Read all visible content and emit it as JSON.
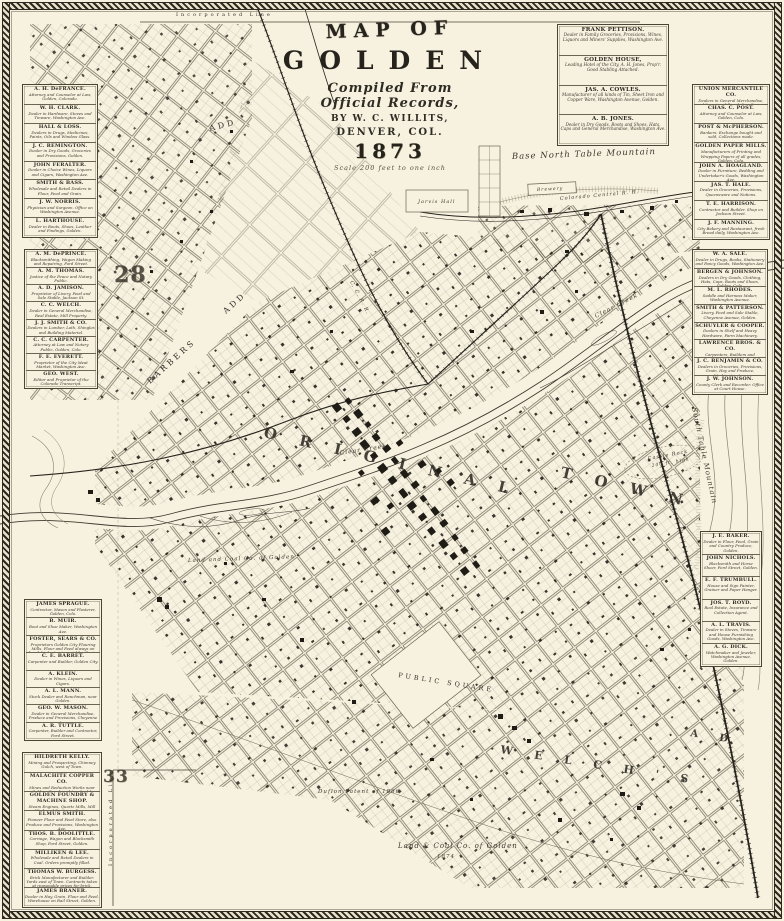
{
  "title": {
    "map_of": "MAP OF",
    "city": "GOLDEN",
    "compiled": "Compiled From",
    "records": "Official Records,",
    "by": "BY W. C. WILLITS,",
    "place": "DENVER, COL.",
    "year": "1873",
    "scale": "Scale 200 feet to one inch"
  },
  "colors": {
    "paper": "#f7f2e0",
    "ink": "#2e2b23",
    "faded_ink": "#6d6553"
  },
  "directories": {
    "top_right": {
      "entries": [
        {
          "name": "FRANK PETTISON.",
          "desc": "Dealer in Family Groceries, Provisions, Wines, Liquors and Miners' Supplies, Washington Ave."
        },
        {
          "name": "GOLDEN HOUSE,",
          "desc": "Leading Hotel of the City, A. H. Jones, Prop'r. Good Stabling Attached."
        },
        {
          "name": "JAS. A. COWLES.",
          "desc": "Manufacturer of all kinds of Tin, Sheet Iron and Copper Ware, Washington Avenue, Golden."
        },
        {
          "name": "A. B. JONES.",
          "desc": "Dealer in Dry Goods, Boots and Shoes, Hats, Caps and General Merchandise, Washington Ave."
        }
      ]
    },
    "left_groups": [
      {
        "entries": [
          {
            "name": "A. H. DeFRANCE.",
            "desc": "Attorney and Counselor at Law, Golden, Colorado."
          },
          {
            "name": "W. H. CLARK.",
            "desc": "Dealer in Hardware, Stoves and Tinware, Washington Ave."
          },
          {
            "name": "HALL & LOSS.",
            "desc": "Dealers in Drugs, Medicines, Paints, Oils and Window Glass."
          },
          {
            "name": "J. C. REMINGTON.",
            "desc": "Dealer in Dry Goods, Groceries and Provisions, Golden."
          },
          {
            "name": "JOHN FERALTER.",
            "desc": "Dealer in Choice Wines, Liquors and Cigars, Washington Ave."
          },
          {
            "name": "SMITH & BASS.",
            "desc": "Wholesale and Retail Dealers in Flour, Feed and Grain."
          },
          {
            "name": "J. W. NORRIS.",
            "desc": "Physician and Surgeon. Office on Washington Avenue."
          },
          {
            "name": "L. HARTHOUSE.",
            "desc": "Dealer in Boots, Shoes, Leather and Findings, Golden."
          }
        ]
      },
      {
        "entries": [
          {
            "name": "A. M. DePRINCE.",
            "desc": "Blacksmithing, Wagon Making and Repairing, Ford Street."
          },
          {
            "name": "A. M. THOMAS.",
            "desc": "Justice of the Peace and Notary Public."
          },
          {
            "name": "A. D. JAMISON.",
            "desc": "Proprietor of Livery, Feed and Sale Stable, Jackson St."
          },
          {
            "name": "C. C. WELCH.",
            "desc": "Dealer in General Merchandise, Real Estate, Mill Property."
          },
          {
            "name": "J. J. SMITH & CO.",
            "desc": "Dealers in Lumber, Lath, Shingles and Building Material."
          },
          {
            "name": "C. C. CARPENTER.",
            "desc": "Attorney at Law and Notary Public, Golden, Colo."
          },
          {
            "name": "F. E. EVERETT.",
            "desc": "Proprietor of the City Meat Market, Washington Ave."
          },
          {
            "name": "GEO. WEST.",
            "desc": "Editor and Proprietor of the Colorado Transcript."
          }
        ]
      },
      {
        "entries": [
          {
            "name": "JAMES SPRAGUE.",
            "desc": "Contractor, Mason and Plasterer, Golden, Colo."
          },
          {
            "name": "B. MUIR.",
            "desc": "Boot and Shoe Maker, Washington Ave."
          },
          {
            "name": "FOSTER, SEARS & CO.",
            "desc": "Proprietors Golden City Flouring Mills. Flour and Feed always on hand, highest price paid for Grain."
          },
          {
            "name": "C. E. BARRET.",
            "desc": "Carpenter and Builder, Golden City."
          },
          {
            "name": "A. KLEIN.",
            "desc": "Dealer in Wines, Liquors and Cigars."
          },
          {
            "name": "A. L. MANN.",
            "desc": "Stock Dealer and Ranchman, near Golden."
          },
          {
            "name": "GEO. W. MASON.",
            "desc": "Dealer in General Merchandise, Produce and Provisions, Cheyenne Ave."
          },
          {
            "name": "A. R. TUTTLE.",
            "desc": "Carpenter, Builder and Contractor, Ford Street."
          }
        ]
      },
      {
        "entries": [
          {
            "name": "HILDRETH KELLY.",
            "desc": "Mining and Prospecting, Chimney Gulch, west of Town."
          },
          {
            "name": "MALACHITE COPPER CO.",
            "desc": "Mines and Reduction Works near Golden. Ores bought and sold."
          },
          {
            "name": "GOLDEN FOUNDRY & MACHINE SHOP.",
            "desc": "Steam Engines, Quartz Mills, Mill Work and Castings of every description. Repairing promptly done."
          },
          {
            "name": "ELMUS SMITH.",
            "desc": "Pioneer Flour and Feed Store, also Produce and Provisions, Washington Ave."
          },
          {
            "name": "THOS. B. DOOLITTLE.",
            "desc": "Carriage, Wagon and Blacksmith Shop, Ford Street, Golden."
          },
          {
            "name": "MILLIKEN & LEE.",
            "desc": "Wholesale and Retail Dealers in Coal. Orders promptly filled."
          },
          {
            "name": "THOMAS W. BURGESS.",
            "desc": "Brick Manufacturer and Builder. Yards east of Town. Contracts taken at reasonable prices for brick."
          },
          {
            "name": "JAMES BRANER.",
            "desc": "Dealer in Hay, Grain, Flour and Feed. Warehouse on Rail Street, Golden."
          }
        ]
      }
    ],
    "right_groups": [
      {
        "entries": [
          {
            "name": "UNION MERCANTILE CO.",
            "desc": "Dealers in General Merchandise, Miners' and Ranch Supplies, Washington Ave."
          },
          {
            "name": "CHAS. C. POST.",
            "desc": "Attorney and Counselor at Law, Golden, Colo."
          },
          {
            "name": "POST & McPHERSON.",
            "desc": "Bankers. Exchange bought and sold, Collections made."
          },
          {
            "name": "GOLDEN PAPER MILLS.",
            "desc": "Manufacturers of Printing and Wrapping Papers of all grades, Golden, Colo."
          },
          {
            "name": "JOHN A. HOAGLAND.",
            "desc": "Dealer in Furniture, Bedding and Undertaker's Goods, Washington Ave."
          },
          {
            "name": "JAS. T. HALE.",
            "desc": "Dealer in Groceries, Provisions, Queensware and Notions."
          },
          {
            "name": "T. E. HARRISON.",
            "desc": "Contractor and Builder. Shop on Jackson Street."
          },
          {
            "name": "J. F. MANNING.",
            "desc": "City Bakery and Restaurant, fresh Bread daily, Washington Ave."
          }
        ]
      },
      {
        "entries": [
          {
            "name": "W. A. SALE.",
            "desc": "Dealer in Drugs, Books, Stationery and Fancy Goods, Washington Ave."
          },
          {
            "name": "BERGEN & JOHNSON.",
            "desc": "Dealers in Dry Goods, Clothing, Hats, Caps, Boots and Shoes, Golden, Colo."
          },
          {
            "name": "M. L. RHODES.",
            "desc": "Saddle and Harness Maker, Washington Avenue."
          },
          {
            "name": "SMITH & PATTERSON.",
            "desc": "Livery, Feed and Sale Stable, Cheyenne Avenue, Golden."
          },
          {
            "name": "SCHUYLER & COOPER.",
            "desc": "Dealers in Shelf and Heavy Hardware, Farm Machinery."
          },
          {
            "name": "LAWRENCE BROS. & CO.",
            "desc": "Carpenters, Builders and Contractors, Golden, Colo."
          },
          {
            "name": "J. C. BENJAMIN & CO.",
            "desc": "Dealers in Groceries, Provisions, Grain, Hay and Produce, Washington Ave."
          },
          {
            "name": "J. W. JOHNSON.",
            "desc": "County Clerk and Recorder. Office at Court House."
          }
        ]
      },
      {
        "entries": [
          {
            "name": "J. E. BAKER.",
            "desc": "Dealer in Flour, Feed, Grain and Country Produce, Golden."
          },
          {
            "name": "JOHN NICHOLS.",
            "desc": "Blacksmith and Horse Shoer, Ford Street, Golden."
          },
          {
            "name": "E. F. TRUMBULL.",
            "desc": "House and Sign Painter, Grainer and Paper Hanger."
          },
          {
            "name": "JOS. T. BOYD.",
            "desc": "Real Estate, Insurance and Collection Agent."
          },
          {
            "name": "A. L. TRAVIS.",
            "desc": "Dealer in Stoves, Tinware and House Furnishing Goods, Washington Ave."
          },
          {
            "name": "A. G. DICK.",
            "desc": "Watchmaker and Jeweler, Washington Avenue, Golden."
          }
        ]
      }
    ]
  },
  "map_labels": [
    {
      "id": "north-table",
      "text": "Base  North  Table  Mountain",
      "x": 512,
      "y": 159,
      "r": -2,
      "s": 8.5,
      "cls": "it"
    },
    {
      "id": "original",
      "text": "O R I G I N A L",
      "x": 263,
      "y": 437,
      "r": 13,
      "s": 15,
      "cls": "big"
    },
    {
      "id": "town",
      "text": "T O W N",
      "x": 560,
      "y": 477,
      "r": 13,
      "s": 15,
      "cls": "big"
    },
    {
      "id": "public-square",
      "text": "PUBLIC  SQUARE",
      "x": 398,
      "y": 677,
      "r": 9,
      "s": 6.5,
      "cls": "sp"
    },
    {
      "id": "welchs",
      "text": "W E L C H ' S",
      "x": 500,
      "y": 753,
      "r": 9,
      "s": 11,
      "cls": "big"
    },
    {
      "id": "welchs-add",
      "text": "A D",
      "x": 690,
      "y": 736,
      "r": 9,
      "s": 10,
      "cls": "big"
    },
    {
      "id": "barbers",
      "text": "BARBERS",
      "x": 150,
      "y": 384,
      "r": -42,
      "s": 8,
      "cls": "sp"
    },
    {
      "id": "barbers-add",
      "text": "ADD",
      "x": 226,
      "y": 314,
      "r": -42,
      "s": 8,
      "cls": "sp"
    },
    {
      "id": "add-nw",
      "text": "ADD",
      "x": 210,
      "y": 131,
      "r": -14,
      "s": 8,
      "cls": "sp"
    },
    {
      "id": "clear-creek-w",
      "text": "Clear  Creek",
      "x": 340,
      "y": 455,
      "r": -9,
      "s": 6,
      "cls": "it"
    },
    {
      "id": "clear-creek-e",
      "text": "Clear  Creek",
      "x": 596,
      "y": 318,
      "r": -27,
      "s": 6,
      "cls": "it"
    },
    {
      "id": "land-coal-w",
      "text": "Land and Coal Co. of Golden",
      "x": 188,
      "y": 562,
      "r": -2,
      "s": 5.5,
      "cls": "it"
    },
    {
      "id": "land-coal-s",
      "text": "Land & Coal Co. of Golden",
      "x": 398,
      "y": 848,
      "r": 0,
      "s": 7,
      "cls": "it"
    },
    {
      "id": "land-coal-s-year",
      "text": "1874",
      "x": 437,
      "y": 858,
      "r": 0,
      "s": 5.5,
      "cls": "it"
    },
    {
      "id": "duflon-patent",
      "text": "Duflon Patent of 1866",
      "x": 318,
      "y": 793,
      "r": 0,
      "s": 5.5,
      "cls": "it"
    },
    {
      "id": "south-table",
      "text": "South  Table  Mountain",
      "x": 692,
      "y": 408,
      "r": 78,
      "s": 7,
      "cls": "it"
    },
    {
      "id": "castle-rock",
      "text": "Castle Rock",
      "x": 648,
      "y": 460,
      "r": -10,
      "s": 5,
      "cls": "it"
    },
    {
      "id": "castle-rock-2",
      "text": "200 ft. high",
      "x": 652,
      "y": 467,
      "r": -10,
      "s": 4.5,
      "cls": "it"
    },
    {
      "id": "section-28",
      "text": "28",
      "x": 114,
      "y": 282,
      "r": 0,
      "s": 22,
      "cls": "sec"
    },
    {
      "id": "section-33",
      "text": "33",
      "x": 103,
      "y": 782,
      "r": 0,
      "s": 17,
      "cls": "sec"
    },
    {
      "id": "incorporated-top",
      "text": "Incorporated  Line",
      "x": 176,
      "y": 16,
      "r": 0,
      "s": 5,
      "cls": "sp"
    },
    {
      "id": "incorporated-left",
      "text": "Incorporated  Line",
      "x": 112,
      "y": 866,
      "r": -90,
      "s": 5,
      "cls": "sp"
    },
    {
      "id": "colorado-central-rr",
      "text": "Colorado  Central  R. R.",
      "x": 560,
      "y": 200,
      "r": -5,
      "s": 5,
      "cls": "it"
    },
    {
      "id": "cc-rr",
      "text": "C. C. R. R.",
      "x": 350,
      "y": 282,
      "r": 62,
      "s": 5,
      "cls": "it"
    },
    {
      "id": "jarvis-hall",
      "text": "Jarvis  Hall",
      "x": 418,
      "y": 203,
      "r": 0,
      "s": 5,
      "cls": "it"
    },
    {
      "id": "brewery",
      "text": "Brewery",
      "x": 537,
      "y": 191,
      "r": -3,
      "s": 4.5,
      "cls": "it"
    }
  ]
}
